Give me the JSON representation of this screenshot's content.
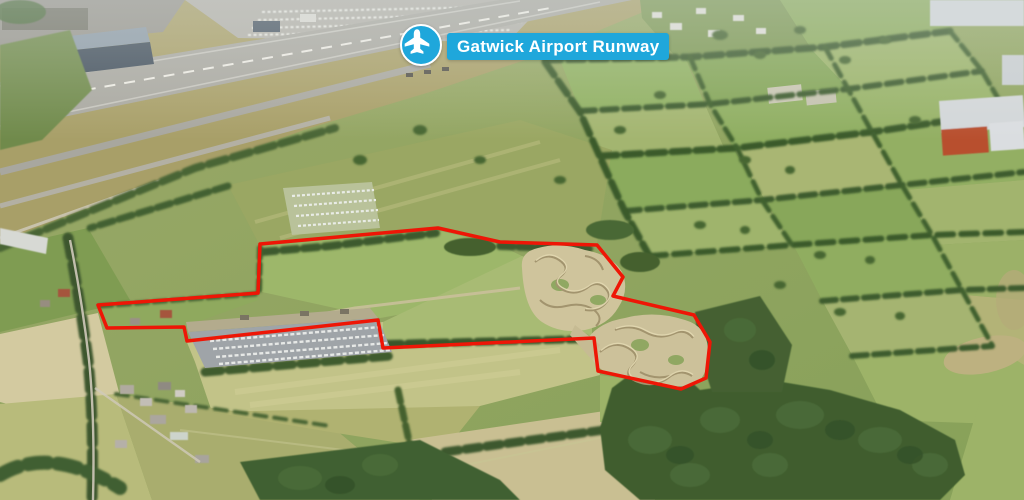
{
  "annotation": {
    "label": "Gatwick Airport Runway",
    "icon": "airplane-icon",
    "colors": {
      "background": "#1fa7db",
      "text": "#ffffff",
      "ring": "#ffffff"
    }
  },
  "boundary": {
    "color": "#ee1606",
    "stroke_width": 3.5,
    "points": [
      [
        260,
        244
      ],
      [
        438,
        228
      ],
      [
        500,
        242
      ],
      [
        597,
        245
      ],
      [
        623,
        277
      ],
      [
        613,
        296
      ],
      [
        694,
        315
      ],
      [
        710,
        342
      ],
      [
        706,
        378
      ],
      [
        681,
        389
      ],
      [
        598,
        371
      ],
      [
        594,
        338
      ],
      [
        383,
        348
      ],
      [
        378,
        320
      ],
      [
        187,
        341
      ],
      [
        184,
        327
      ],
      [
        107,
        328
      ],
      [
        98,
        305
      ],
      [
        258,
        293
      ]
    ]
  },
  "scene": {
    "palette": {
      "field_green": "#94ad62",
      "pale_field": "#c2c388",
      "tree_green": "#415e2f",
      "dirt_tan": "#ccc19a",
      "runway_grey": "#a9a8a0"
    }
  }
}
